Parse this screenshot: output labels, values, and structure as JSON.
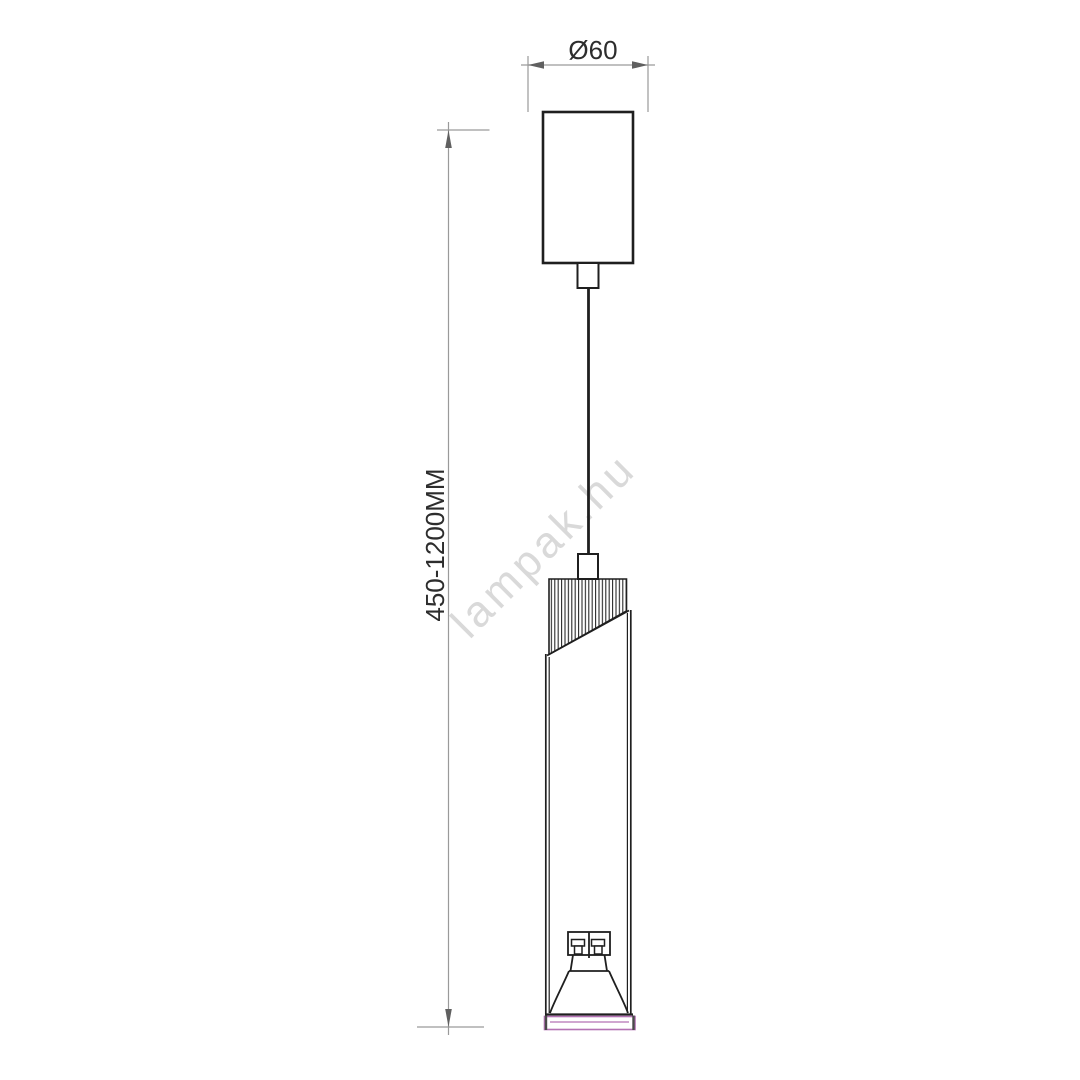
{
  "drawing": {
    "diameter_dimension": {
      "label": "Ø60"
    },
    "height_dimension": {
      "label": "450-1200MM"
    },
    "watermark": {
      "label": "lampak.hu"
    }
  },
  "colors": {
    "outline": "#1f1f1f",
    "dimension_line": "#9a9a9a",
    "dimension_arrow": "#606060",
    "dimension_text": "#2d2d2d",
    "watermark": "#d9d9d9",
    "trim_accent": "#b472b4",
    "trim_cap": "#4a4a4a",
    "background": "#ffffff"
  }
}
